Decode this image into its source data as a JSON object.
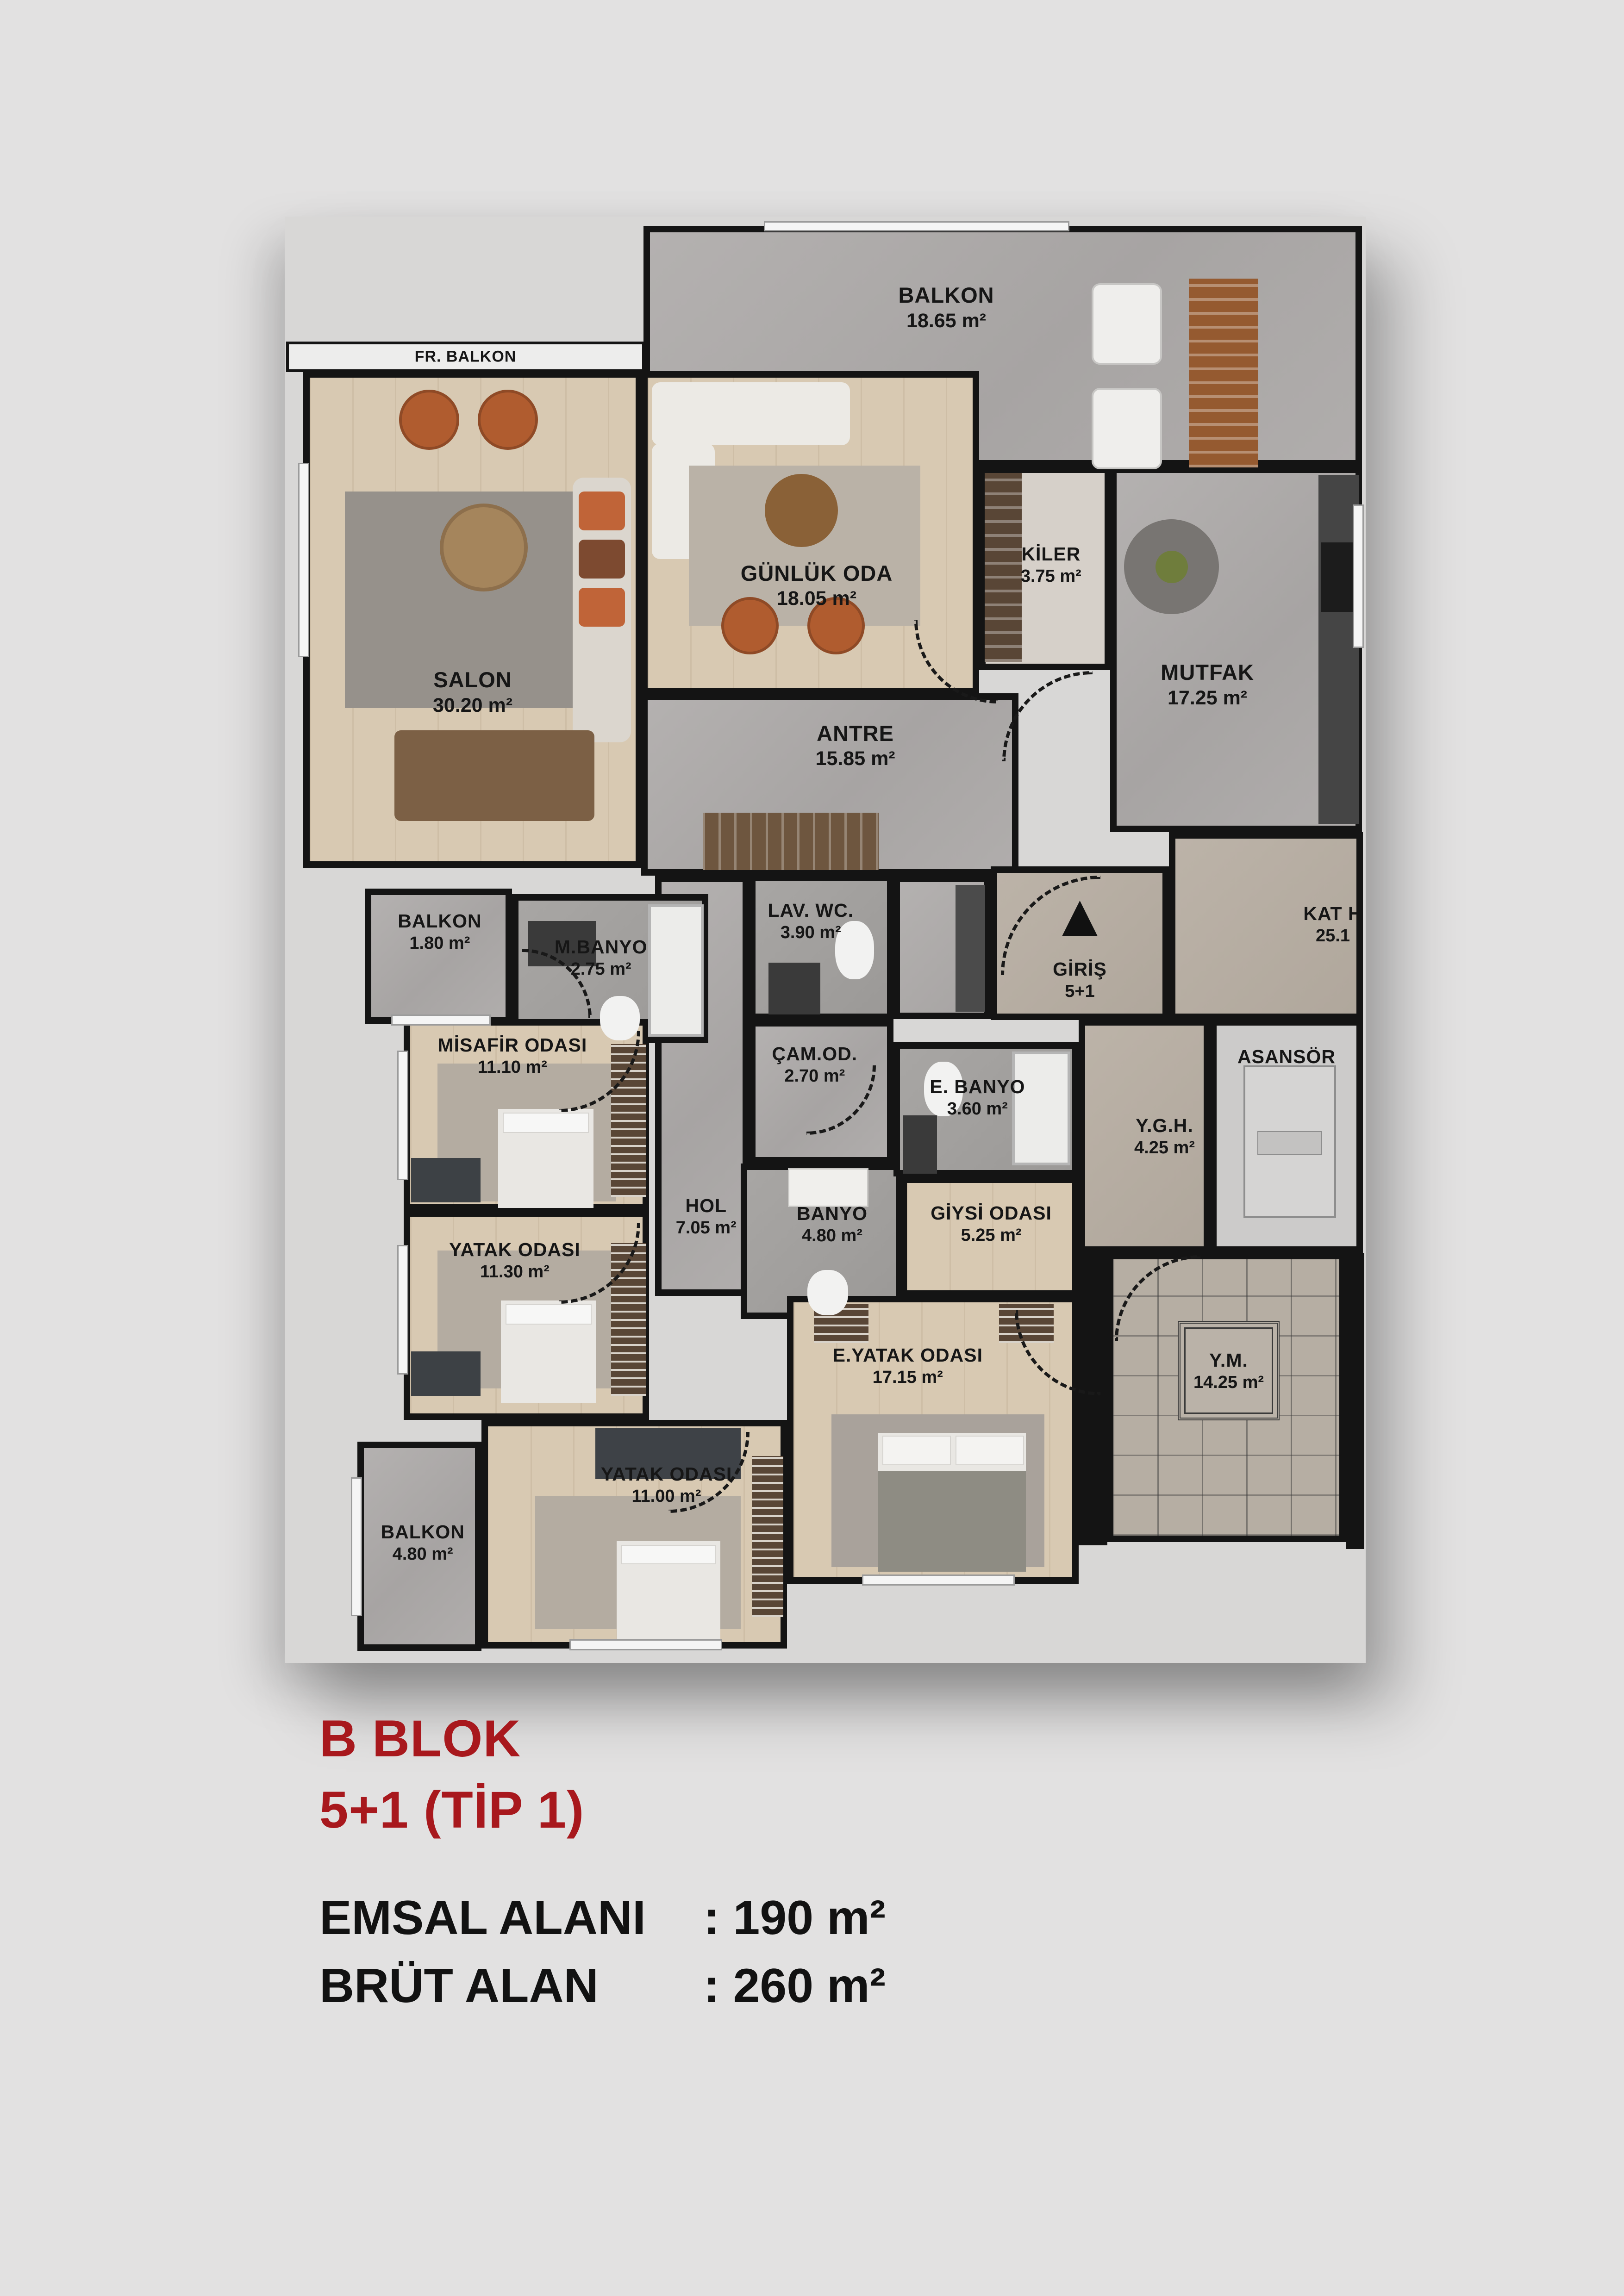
{
  "plan": {
    "rooms": [
      {
        "name": "BALKON",
        "area": "18.65 m²"
      },
      {
        "name": "FR. BALKON",
        "area": ""
      },
      {
        "name": "SALON",
        "area": "30.20 m²"
      },
      {
        "name": "GÜNLÜK ODA",
        "area": "18.05 m²"
      },
      {
        "name": "KİLER",
        "area": "3.75 m²"
      },
      {
        "name": "MUTFAK",
        "area": "17.25 m²"
      },
      {
        "name": "ANTRE",
        "area": "15.85 m²"
      },
      {
        "name": "LAV. WC.",
        "area": "3.90 m²"
      },
      {
        "name": "GİRİŞ",
        "area": "5+1"
      },
      {
        "name": "KAT H",
        "area": "25.1"
      },
      {
        "name": "BALKON",
        "area": "1.80 m²"
      },
      {
        "name": "M.BANYO",
        "area": "2.75 m²"
      },
      {
        "name": "MİSAFİR ODASI",
        "area": "11.10 m²"
      },
      {
        "name": "ÇAM.OD.",
        "area": "2.70 m²"
      },
      {
        "name": "E. BANYO",
        "area": "3.60 m²"
      },
      {
        "name": "Y.G.H.",
        "area": "4.25 m²"
      },
      {
        "name": "ASANSÖR",
        "area": ""
      },
      {
        "name": "HOL",
        "area": "7.05 m²"
      },
      {
        "name": "BANYO",
        "area": "4.80 m²"
      },
      {
        "name": "GİYSİ ODASI",
        "area": "5.25 m²"
      },
      {
        "name": "YATAK ODASI",
        "area": "11.30 m²"
      },
      {
        "name": "E.YATAK ODASI",
        "area": "17.15 m²"
      },
      {
        "name": "Y.M.",
        "area": "14.25 m²"
      },
      {
        "name": "YATAK ODASI",
        "area": "11.00 m²"
      },
      {
        "name": "BALKON",
        "area": "4.80 m²"
      }
    ]
  },
  "icons": {
    "entrance_arrow": "▲"
  },
  "title_block": {
    "block_name": "B BLOK",
    "unit_type": "5+1 (TİP 1)",
    "rows": [
      {
        "label": "EMSAL ALANI",
        "value": ": 190 m²"
      },
      {
        "label": "BRÜT ALAN",
        "value": ": 260 m²"
      }
    ]
  },
  "colors": {
    "page_background": "#e2e1e1",
    "wall": "#141414",
    "accent_red": "#A8181D",
    "wood_floor": "#d8c9b2",
    "marble_gray": "#aeabaa",
    "tile_gray": "#a2a09e",
    "marble_beige": "#b7aea3",
    "elevator_gray": "#cccbca",
    "railing_white": "#ededec"
  }
}
